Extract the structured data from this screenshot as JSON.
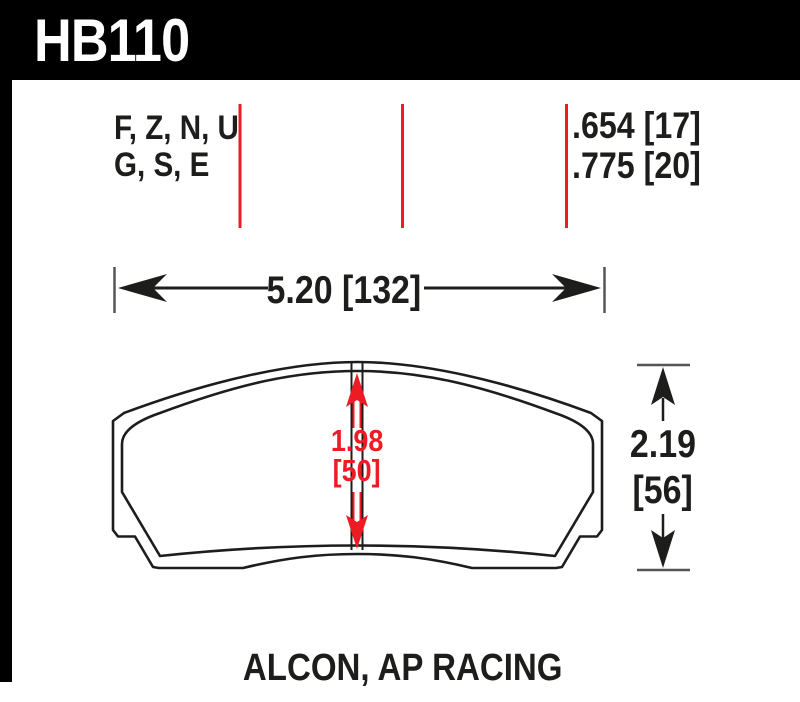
{
  "window": {
    "width": 800,
    "height": 702
  },
  "header": {
    "part_number": "HB110"
  },
  "compound_codes": {
    "line1": "F, Z, N, U",
    "line2": "G, S, E"
  },
  "pad_thickness": {
    "line1": ".654 [17]",
    "line2": ".775 [20]"
  },
  "dimensions": {
    "width_label": "5.20 [132]",
    "friction_height_value": "1.98",
    "friction_height_mm": "[50]",
    "overall_height_value": "2.19",
    "overall_height_mm": "[56]"
  },
  "caption": "ALCON, AP RACING",
  "colors": {
    "header_bg": "#000000",
    "header_text": "#ffffff",
    "accent_red": "#ed1c24",
    "line_color": "#1d1d1b",
    "tick_color": "#555555",
    "canvas": "#ffffff"
  }
}
